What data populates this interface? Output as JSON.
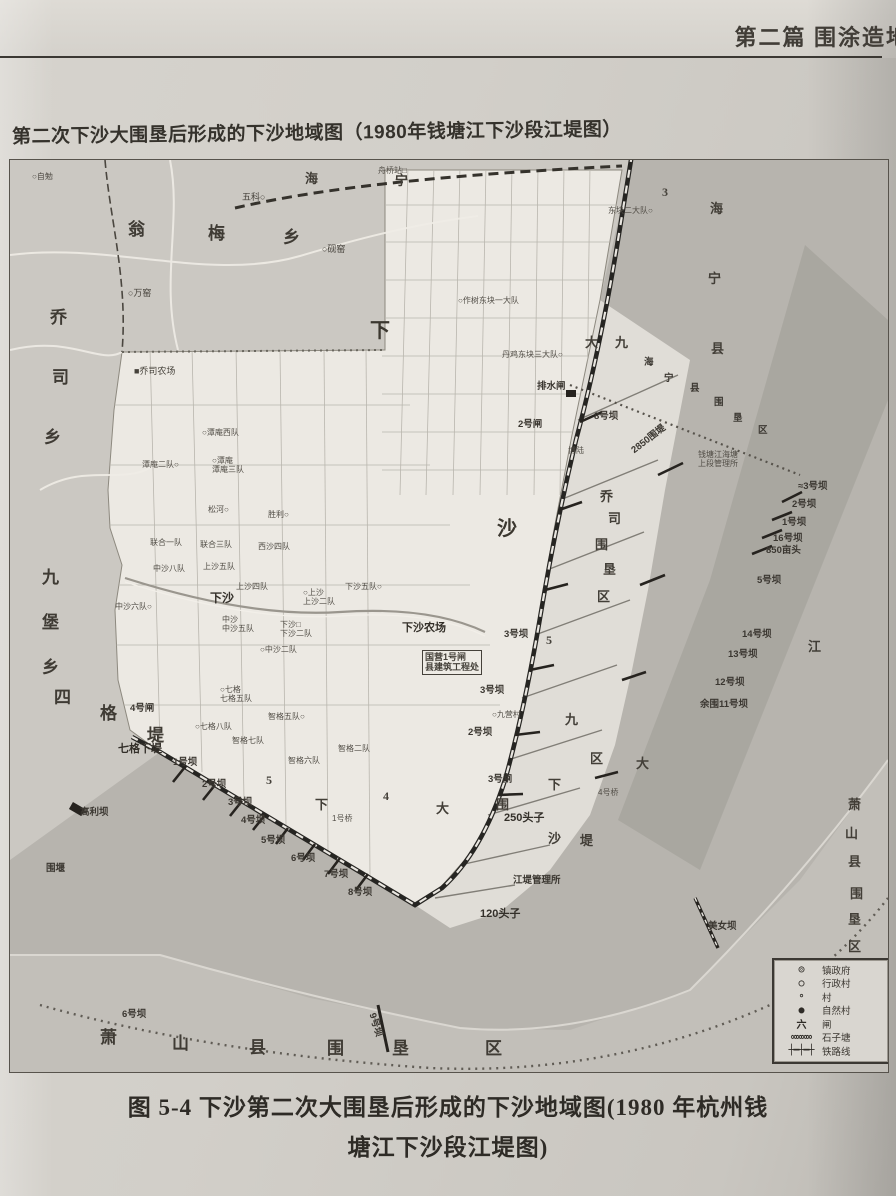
{
  "page": {
    "header": "第二篇 围涂造地",
    "map_title": "第二次下沙大围垦后形成的下沙地域图（1980年钱塘江下沙段江堤图）",
    "caption_line1": "图 5-4 下沙第二次大围垦后形成的下沙地域图(1980 年杭州钱",
    "caption_line2": "塘江下沙段江堤图)"
  },
  "colors": {
    "paper": "#d2cfc9",
    "land_gray": "#cbc8c2",
    "xiasha_white": "#ece9e3",
    "strip": "#e0ddd7",
    "river": "#b7b4ae",
    "channel": "#a7a49e",
    "south_band": "#c2bfb9",
    "ink": "#3b3833"
  },
  "legend": {
    "rows": [
      {
        "symbol": "◎",
        "label": "镇政府"
      },
      {
        "symbol": "○",
        "label": "行政村"
      },
      {
        "symbol": "∘",
        "label": "村"
      },
      {
        "symbol": "●",
        "label": "自然村"
      },
      {
        "symbol": "六",
        "label": "闸"
      },
      {
        "symbol": "∞∞∞∞",
        "label": "石子塘"
      },
      {
        "symbol": "┼━┼━┼",
        "label": "铁路线"
      }
    ]
  },
  "map": {
    "labels": [
      {
        "t": "翁",
        "x": 118,
        "y": 60,
        "cls": "big"
      },
      {
        "t": "梅",
        "x": 198,
        "y": 64,
        "cls": "big"
      },
      {
        "t": "乡",
        "x": 273,
        "y": 68,
        "cls": "big"
      },
      {
        "t": "海",
        "x": 295,
        "y": 12,
        "cls": "mid"
      },
      {
        "t": "宁",
        "x": 385,
        "y": 14,
        "cls": "mid"
      },
      {
        "t": "乔",
        "x": 40,
        "y": 148,
        "cls": "big"
      },
      {
        "t": "司",
        "x": 42,
        "y": 208,
        "cls": "big"
      },
      {
        "t": "乡",
        "x": 34,
        "y": 268,
        "cls": "big"
      },
      {
        "t": "九",
        "x": 32,
        "y": 408,
        "cls": "big"
      },
      {
        "t": "堡",
        "x": 32,
        "y": 453,
        "cls": "big"
      },
      {
        "t": "乡",
        "x": 32,
        "y": 498,
        "cls": "big"
      },
      {
        "t": "下",
        "x": 360,
        "y": 160,
        "cls": "huge"
      },
      {
        "t": "沙",
        "x": 487,
        "y": 358,
        "cls": "huge"
      },
      {
        "t": "大",
        "x": 575,
        "y": 176,
        "cls": "mid"
      },
      {
        "t": "九",
        "x": 605,
        "y": 176,
        "cls": "mid"
      },
      {
        "t": "海",
        "x": 700,
        "y": 42,
        "cls": "mid"
      },
      {
        "t": "宁",
        "x": 698,
        "y": 112,
        "cls": "mid"
      },
      {
        "t": "县",
        "x": 701,
        "y": 182,
        "cls": "mid"
      },
      {
        "t": "海",
        "x": 634,
        "y": 198,
        "cls": "dam"
      },
      {
        "t": "宁",
        "x": 654,
        "y": 214,
        "cls": "dam"
      },
      {
        "t": "县",
        "x": 680,
        "y": 224,
        "cls": "dam"
      },
      {
        "t": "围",
        "x": 704,
        "y": 238,
        "cls": "dam"
      },
      {
        "t": "垦",
        "x": 723,
        "y": 254,
        "cls": "dam"
      },
      {
        "t": "区",
        "x": 748,
        "y": 266,
        "cls": "dam"
      },
      {
        "t": "乔",
        "x": 590,
        "y": 330,
        "cls": "mid"
      },
      {
        "t": "司",
        "x": 598,
        "y": 352,
        "cls": "mid"
      },
      {
        "t": "围",
        "x": 585,
        "y": 378,
        "cls": "mid"
      },
      {
        "t": "垦",
        "x": 593,
        "y": 403,
        "cls": "mid"
      },
      {
        "t": "区",
        "x": 587,
        "y": 430,
        "cls": "mid"
      },
      {
        "t": "九",
        "x": 555,
        "y": 553,
        "cls": "mid"
      },
      {
        "t": "区",
        "x": 580,
        "y": 592,
        "cls": "mid"
      },
      {
        "t": "大",
        "x": 626,
        "y": 597,
        "cls": "mid"
      },
      {
        "t": "下",
        "x": 538,
        "y": 618,
        "cls": "mid"
      },
      {
        "t": "沙",
        "x": 538,
        "y": 672,
        "cls": "mid"
      },
      {
        "t": "堤",
        "x": 570,
        "y": 674,
        "cls": "mid"
      },
      {
        "t": "下",
        "x": 305,
        "y": 638,
        "cls": "mid"
      },
      {
        "t": "大",
        "x": 426,
        "y": 642,
        "cls": "mid"
      },
      {
        "t": "围",
        "x": 486,
        "y": 638,
        "cls": "mid"
      },
      {
        "t": "四",
        "x": 44,
        "y": 528,
        "cls": "big"
      },
      {
        "t": "格",
        "x": 90,
        "y": 544,
        "cls": "big"
      },
      {
        "t": "堤",
        "x": 137,
        "y": 566,
        "cls": "big"
      },
      {
        "t": "江",
        "x": 798,
        "y": 480,
        "cls": "mid"
      },
      {
        "t": "萧",
        "x": 90,
        "y": 868,
        "cls": "big"
      },
      {
        "t": "山",
        "x": 162,
        "y": 874,
        "cls": "big"
      },
      {
        "t": "县",
        "x": 239,
        "y": 878,
        "cls": "big"
      },
      {
        "t": "围",
        "x": 317,
        "y": 879,
        "cls": "big"
      },
      {
        "t": "垦",
        "x": 382,
        "y": 879,
        "cls": "big"
      },
      {
        "t": "区",
        "x": 475,
        "y": 879,
        "cls": "big"
      },
      {
        "t": "萧",
        "x": 838,
        "y": 638,
        "cls": "mid"
      },
      {
        "t": "山",
        "x": 835,
        "y": 667,
        "cls": "mid"
      },
      {
        "t": "县",
        "x": 838,
        "y": 695,
        "cls": "mid"
      },
      {
        "t": "围",
        "x": 840,
        "y": 727,
        "cls": "mid"
      },
      {
        "t": "垦",
        "x": 838,
        "y": 753,
        "cls": "mid"
      },
      {
        "t": "区",
        "x": 838,
        "y": 780,
        "cls": "mid"
      },
      {
        "t": "○自勉",
        "x": 22,
        "y": 12,
        "cls": "tiny"
      },
      {
        "t": "五科○",
        "x": 232,
        "y": 32
      },
      {
        "t": "○砚窑",
        "x": 312,
        "y": 84
      },
      {
        "t": "○万窑",
        "x": 118,
        "y": 128
      },
      {
        "t": "舟桥站□",
        "x": 368,
        "y": 6,
        "cls": "tiny"
      },
      {
        "t": "3",
        "x": 652,
        "y": 26,
        "cls": "num"
      },
      {
        "t": "■乔司农场",
        "x": 124,
        "y": 206
      },
      {
        "t": "东块二大队○",
        "x": 598,
        "y": 46,
        "cls": "tiny"
      },
      {
        "t": "○作树东块一大队",
        "x": 448,
        "y": 136,
        "cls": "tiny"
      },
      {
        "t": "丹鸡东块三大队○",
        "x": 492,
        "y": 190,
        "cls": "tiny"
      },
      {
        "t": "○潭庵西队",
        "x": 192,
        "y": 268,
        "cls": "tiny"
      },
      {
        "t": "潭庵二队○",
        "x": 132,
        "y": 300,
        "cls": "tiny"
      },
      {
        "t": "○潭庵\n潭庵三队",
        "x": 202,
        "y": 296,
        "cls": "tiny"
      },
      {
        "t": "松河○",
        "x": 198,
        "y": 345,
        "cls": "tiny"
      },
      {
        "t": "胜利○",
        "x": 258,
        "y": 350,
        "cls": "tiny"
      },
      {
        "t": "联合一队",
        "x": 140,
        "y": 378,
        "cls": "tiny"
      },
      {
        "t": "联合三队",
        "x": 190,
        "y": 380,
        "cls": "tiny"
      },
      {
        "t": "西沙四队",
        "x": 248,
        "y": 382,
        "cls": "tiny"
      },
      {
        "t": "中沙八队",
        "x": 143,
        "y": 404,
        "cls": "tiny"
      },
      {
        "t": "上沙五队",
        "x": 193,
        "y": 402,
        "cls": "tiny"
      },
      {
        "t": "上沙四队",
        "x": 226,
        "y": 422,
        "cls": "tiny"
      },
      {
        "t": "下沙五队○",
        "x": 335,
        "y": 422,
        "cls": "tiny"
      },
      {
        "t": "下沙",
        "x": 200,
        "y": 432,
        "cls": "town"
      },
      {
        "t": "○上沙\n上沙二队",
        "x": 293,
        "y": 428,
        "cls": "tiny"
      },
      {
        "t": "中沙\n中沙五队",
        "x": 212,
        "y": 455,
        "cls": "tiny"
      },
      {
        "t": "中沙六队○",
        "x": 105,
        "y": 442,
        "cls": "tiny"
      },
      {
        "t": "下沙□\n下沙二队",
        "x": 270,
        "y": 460,
        "cls": "tiny"
      },
      {
        "t": "○中沙二队",
        "x": 250,
        "y": 485,
        "cls": "tiny"
      },
      {
        "t": "下沙农场",
        "x": 392,
        "y": 462,
        "cls": "head"
      },
      {
        "t": "排水闸",
        "x": 527,
        "y": 222,
        "cls": "dam"
      },
      {
        "t": "2号闸",
        "x": 508,
        "y": 260,
        "cls": "dam"
      },
      {
        "t": "8号坝",
        "x": 584,
        "y": 252,
        "cls": "dam"
      },
      {
        "t": "博陆",
        "x": 558,
        "y": 286,
        "cls": "tiny"
      },
      {
        "t": "2850围堤",
        "x": 620,
        "y": 288,
        "cls": "dam",
        "r": -38
      },
      {
        "t": "钱塘江海塘\n上段管理所",
        "x": 688,
        "y": 290,
        "cls": "tiny"
      },
      {
        "t": "≈3号坝",
        "x": 788,
        "y": 322,
        "cls": "dam"
      },
      {
        "t": "2号坝",
        "x": 782,
        "y": 340,
        "cls": "dam"
      },
      {
        "t": "1号坝",
        "x": 772,
        "y": 358,
        "cls": "dam"
      },
      {
        "t": "16号坝",
        "x": 763,
        "y": 374,
        "cls": "dam"
      },
      {
        "t": "850亩头",
        "x": 756,
        "y": 386,
        "cls": "dam"
      },
      {
        "t": "5号坝",
        "x": 747,
        "y": 416,
        "cls": "dam"
      },
      {
        "t": "14号坝",
        "x": 732,
        "y": 470,
        "cls": "dam"
      },
      {
        "t": "13号坝",
        "x": 718,
        "y": 490,
        "cls": "dam"
      },
      {
        "t": "12号坝",
        "x": 705,
        "y": 518,
        "cls": "dam"
      },
      {
        "t": "余围11号坝",
        "x": 690,
        "y": 540,
        "cls": "dam"
      },
      {
        "t": "国营1号闸\n县建筑工程处",
        "x": 412,
        "y": 490,
        "cls": "boxed"
      },
      {
        "t": "3号坝",
        "x": 494,
        "y": 470,
        "cls": "dam"
      },
      {
        "t": "5",
        "x": 536,
        "y": 474,
        "cls": "num"
      },
      {
        "t": "○七格\n七格五队",
        "x": 210,
        "y": 525,
        "cls": "tiny"
      },
      {
        "t": "4号闸",
        "x": 120,
        "y": 544,
        "cls": "dam"
      },
      {
        "t": "○七格八队",
        "x": 185,
        "y": 562,
        "cls": "tiny"
      },
      {
        "t": "智格五队○",
        "x": 258,
        "y": 552,
        "cls": "tiny"
      },
      {
        "t": "智格七队",
        "x": 222,
        "y": 576,
        "cls": "tiny"
      },
      {
        "t": "智格二队",
        "x": 328,
        "y": 584,
        "cls": "tiny"
      },
      {
        "t": "智格六队",
        "x": 278,
        "y": 596,
        "cls": "tiny"
      },
      {
        "t": "七格下堤",
        "x": 108,
        "y": 583,
        "cls": "head"
      },
      {
        "t": "3号坝",
        "x": 470,
        "y": 526,
        "cls": "dam"
      },
      {
        "t": "○九营村",
        "x": 482,
        "y": 550,
        "cls": "tiny"
      },
      {
        "t": "2号坝",
        "x": 458,
        "y": 568,
        "cls": "dam"
      },
      {
        "t": "3号闸",
        "x": 478,
        "y": 615,
        "cls": "dam"
      },
      {
        "t": "1号坝",
        "x": 163,
        "y": 598,
        "cls": "dam"
      },
      {
        "t": "2号坝",
        "x": 192,
        "y": 620,
        "cls": "dam"
      },
      {
        "t": "3号坝",
        "x": 218,
        "y": 638,
        "cls": "dam"
      },
      {
        "t": "4号坝",
        "x": 231,
        "y": 656,
        "cls": "dam"
      },
      {
        "t": "5号坝",
        "x": 251,
        "y": 676,
        "cls": "dam"
      },
      {
        "t": "6号坝",
        "x": 281,
        "y": 694,
        "cls": "dam"
      },
      {
        "t": "7号坝",
        "x": 314,
        "y": 710,
        "cls": "dam"
      },
      {
        "t": "8号坝",
        "x": 338,
        "y": 728,
        "cls": "dam"
      },
      {
        "t": "5",
        "x": 256,
        "y": 614,
        "cls": "num"
      },
      {
        "t": "4",
        "x": 373,
        "y": 630,
        "cls": "num"
      },
      {
        "t": "1号桥",
        "x": 322,
        "y": 654,
        "cls": "tiny"
      },
      {
        "t": "4号桥",
        "x": 588,
        "y": 628,
        "cls": "tiny"
      },
      {
        "t": "250头子",
        "x": 494,
        "y": 652,
        "cls": "head"
      },
      {
        "t": "江堤管理所",
        "x": 503,
        "y": 716,
        "cls": "dam"
      },
      {
        "t": "120头子",
        "x": 470,
        "y": 748,
        "cls": "head"
      },
      {
        "t": "美女坝",
        "x": 698,
        "y": 762,
        "cls": "dam"
      },
      {
        "t": "高利坝",
        "x": 70,
        "y": 648,
        "cls": "dam"
      },
      {
        "t": "围堰",
        "x": 36,
        "y": 704,
        "cls": "dam"
      },
      {
        "t": "6号坝",
        "x": 112,
        "y": 850,
        "cls": "dam"
      },
      {
        "t": "9号坝",
        "x": 366,
        "y": 852,
        "cls": "dam",
        "r": 72
      }
    ]
  }
}
